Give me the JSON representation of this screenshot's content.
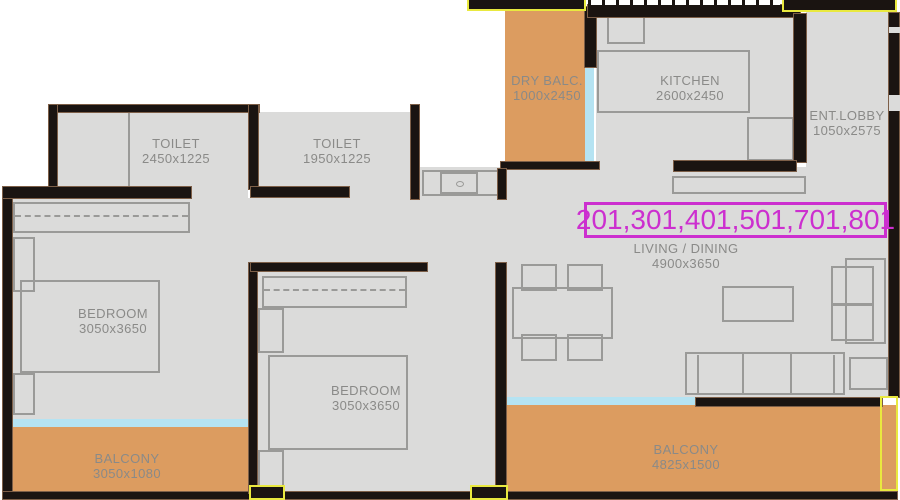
{
  "flat_numbers": "201,301,401,501,701,801",
  "rooms": {
    "toilet1": {
      "name": "TOILET",
      "dims": "2450x1225"
    },
    "toilet2": {
      "name": "TOILET",
      "dims": "1950x1225"
    },
    "dry_balcony": {
      "name": "DRY BALC.",
      "dims": "1000x2450"
    },
    "kitchen": {
      "name": "KITCHEN",
      "dims": "2600x2450"
    },
    "ent_lobby": {
      "name": "ENT.LOBBY",
      "dims": "1050x2575"
    },
    "living_dining": {
      "name": "LIVING / DINING",
      "dims": "4900x3650"
    },
    "bedroom1": {
      "name": "BEDROOM",
      "dims": "3050x3650"
    },
    "bedroom2": {
      "name": "BEDROOM",
      "dims": "3050x3650"
    },
    "balcony1": {
      "name": "BALCONY",
      "dims": "3050x1080"
    },
    "balcony2": {
      "name": "BALCONY",
      "dims": "4825x1500"
    }
  },
  "colors": {
    "wall": "#1a1411",
    "wood": "#7d5f48",
    "floor": "#dbdbda",
    "balcony": "#dc9c60",
    "glass": "#b5e3f2",
    "line": "#9a9a98",
    "text": "#8a8a88",
    "magenta": "#cc2fcf",
    "highlight": "#e9e93f"
  }
}
